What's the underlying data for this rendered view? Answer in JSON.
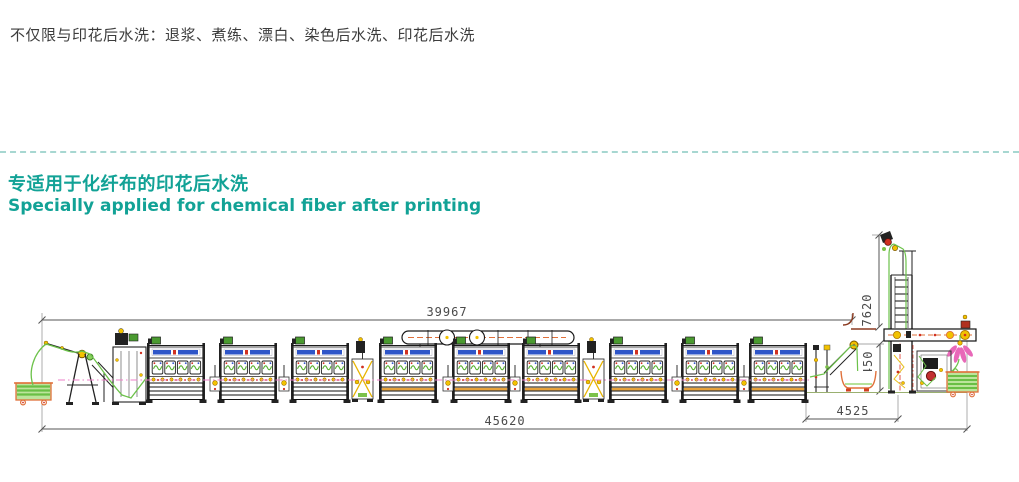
{
  "page": {
    "intro_note": "不仅限与印花后水洗：退浆、煮练、漂白、染色后水洗、印花后水洗",
    "heading_zh": "专适用于化纤布的印花后水洗",
    "heading_en": "Specially applied for chemical fiber after printing",
    "accent_color": "#12a296"
  },
  "diagram": {
    "type": "engineering-side-elevation",
    "subject": "open-width washing range line with 9 washing chambers, cloth carts, exhaust duct, delivery tower and plaiter",
    "dimensions": {
      "machine_length": "39967",
      "overall_length": "45620",
      "delivery_length": "4525",
      "plaiting_height": "2450",
      "tower_height": "7620"
    },
    "units": [
      {
        "x": 147,
        "variant": "plain"
      },
      {
        "x": 219,
        "variant": "plain"
      },
      {
        "x": 291,
        "variant": "plain"
      },
      {
        "x": 379,
        "variant": "warm"
      },
      {
        "x": 452,
        "variant": "warm"
      },
      {
        "x": 522,
        "variant": "warm"
      },
      {
        "x": 609,
        "variant": "warm"
      },
      {
        "x": 681,
        "variant": "warm"
      },
      {
        "x": 749,
        "variant": "warm"
      }
    ],
    "connectors": [
      210,
      279,
      443,
      510,
      672,
      739
    ],
    "pumps": [
      352,
      583
    ],
    "colors": {
      "line": "#1a1a1a",
      "green": "#6cc24a",
      "dark_green": "#4a9a30",
      "yellow": "#f2c200",
      "orange": "#e0703a",
      "red": "#d03020",
      "blue": "#2e55c8",
      "pink": "#e868b8",
      "dim": "#555555"
    }
  }
}
